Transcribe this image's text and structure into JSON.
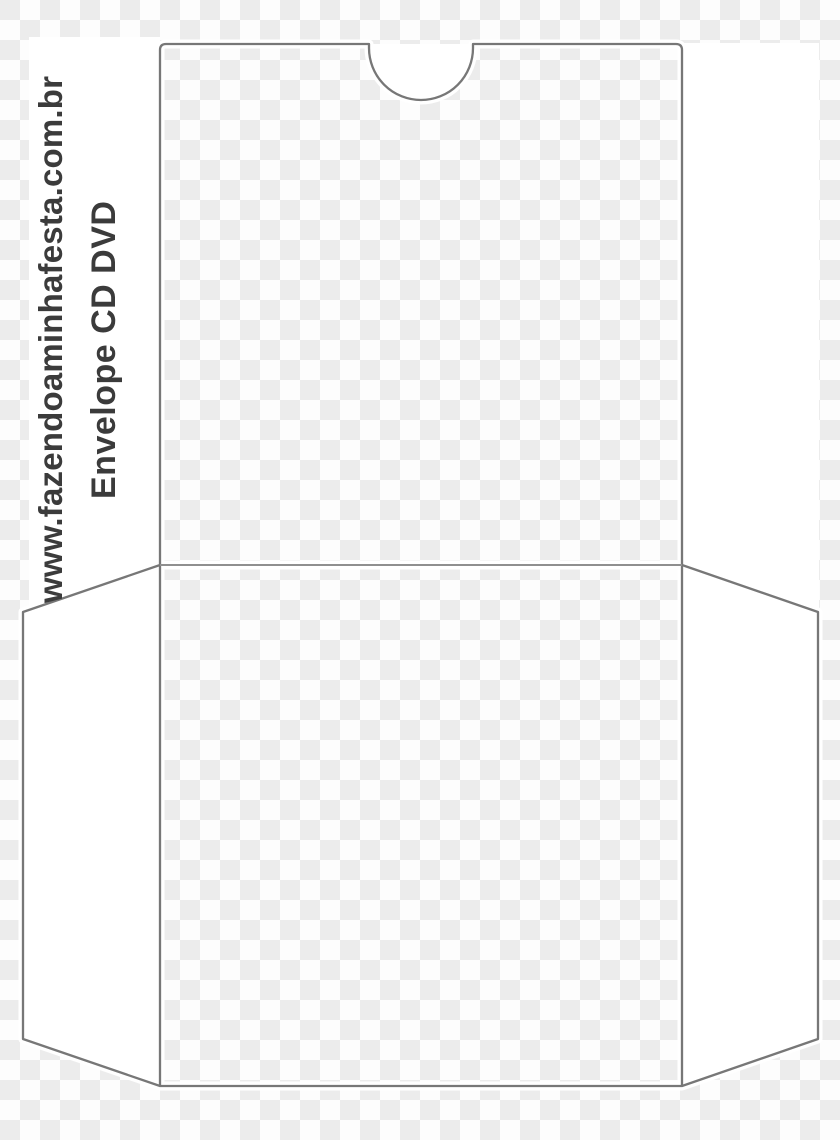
{
  "watermark": {
    "site_url": "www.fazendoaminhafesta.com.br",
    "title": "Envelope CD DVD"
  },
  "template": {
    "subject": "cd-dvd-envelope-die-cut-template",
    "outline_color": "#777777",
    "fold_line_color": "#8f8f8f",
    "halo_color": "#ffffff",
    "flap_fill_color": "#ffffff",
    "text_color": "#3b3b3b",
    "checker_light": "#fdfdfd",
    "checker_dark": "#ececec"
  }
}
